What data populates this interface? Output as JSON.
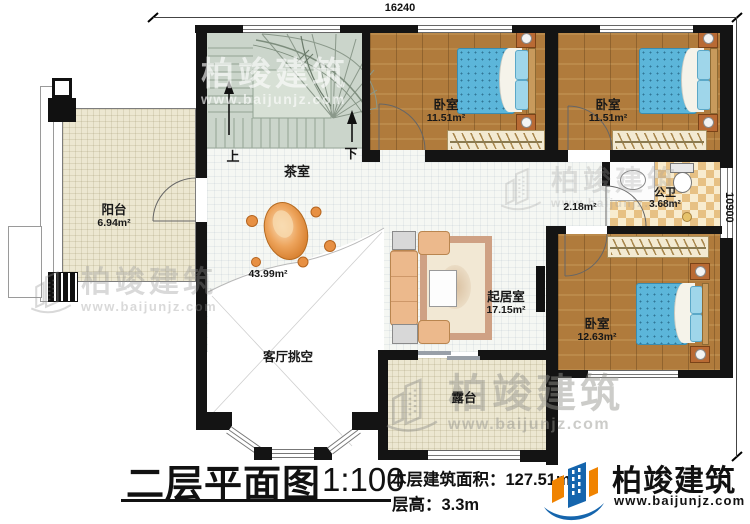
{
  "title_block": {
    "plan_title": "二层平面图",
    "scale": "1:100",
    "area_label": "本层建筑面积：",
    "area_value": "127.51m²",
    "height_label": "层高：",
    "height_value": "3.3m"
  },
  "brand": {
    "name": "柏竣建筑",
    "website": "www.baijunjz.com",
    "blue": "#1565ad",
    "orange": "#f08300"
  },
  "dimensions": {
    "top_width": "16240",
    "right_height": "10900"
  },
  "stairs": {
    "up": "上",
    "down": "下"
  },
  "rooms": [
    {
      "id": "balcony",
      "name": "阳台",
      "area": "6.94m²"
    },
    {
      "id": "tea-room",
      "name": "茶室",
      "area": ""
    },
    {
      "id": "hall",
      "name": "",
      "area": "43.99m²"
    },
    {
      "id": "bedroom-1",
      "name": "卧室",
      "area": "11.51m²"
    },
    {
      "id": "bedroom-2",
      "name": "卧室",
      "area": "11.51m²"
    },
    {
      "id": "bathroom",
      "name": "公卫",
      "area": "3.68m²"
    },
    {
      "id": "hallway",
      "name": "",
      "area": "2.18m²"
    },
    {
      "id": "bedroom-3",
      "name": "卧室",
      "area": "12.63m²"
    },
    {
      "id": "living",
      "name": "起居室",
      "area": "17.15m²"
    },
    {
      "id": "void",
      "name": "客厅挑空",
      "area": ""
    },
    {
      "id": "terrace",
      "name": "露台",
      "area": ""
    }
  ]
}
